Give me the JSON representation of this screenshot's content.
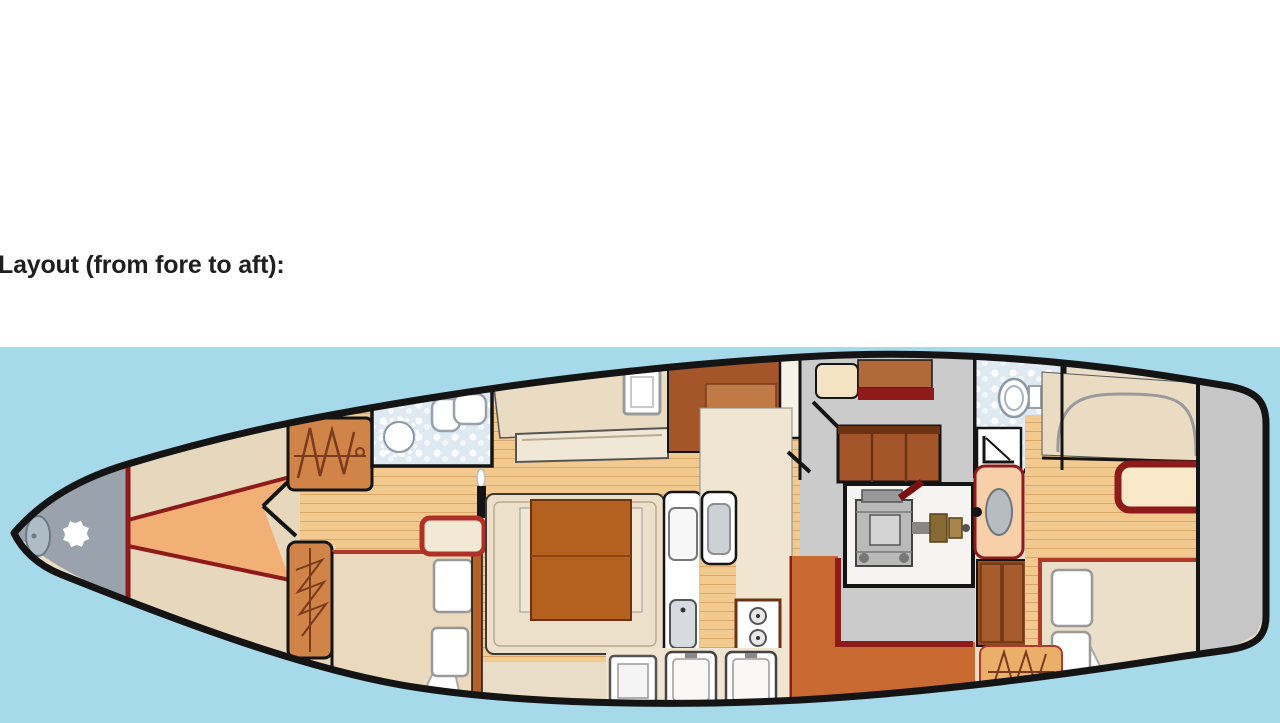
{
  "page": {
    "heading": "Layout (from fore to aft):",
    "background": "#ffffff"
  },
  "diagram": {
    "kind": "sailing-yacht-interior-deck-plan",
    "orientation": "bow-left-stern-right",
    "colors": {
      "water": "#a6d9e9",
      "hull_outline": "#141414",
      "interior_base": "#e9ddc8",
      "plank_floor": "#f2c98e",
      "plank_line": "#d9a868",
      "accent_red": "#8e1a1a",
      "bed_frame_red": "#b03a2a",
      "furniture_brown": "#a5552a",
      "wardrobe_orange": "#d08448",
      "galley_bulkhead_orange": "#c96a33",
      "nav_gray": "#cbcbcb",
      "anchor_locker_gray": "#9aa3ad",
      "head_tiles": "#dfe9f2",
      "cushion_cream": "#ece0ca"
    },
    "areas_fore_to_aft": [
      "anchor-locker",
      "v-berth-cabin",
      "hanging-wardrobe",
      "forward-head",
      "port-single-berth",
      "starboard-double-cabin",
      "saloon-u-settee-with-table",
      "galley-with-sink-stove-fridges",
      "navigation-area-companionway",
      "engine-room",
      "aft-head-with-shower",
      "aft-cabin-double-berth",
      "transom-locker"
    ]
  }
}
